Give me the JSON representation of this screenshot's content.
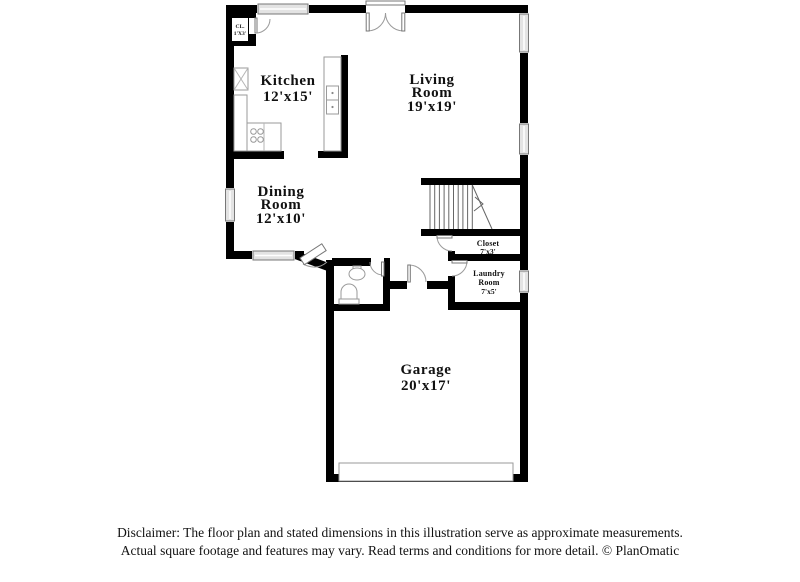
{
  "floor_plan": {
    "rooms": {
      "kitchen": {
        "name": "Kitchen",
        "dims": "12'x15'"
      },
      "living_room": {
        "name_1": "Living",
        "name_2": "Room",
        "dims": "19'x19'"
      },
      "dining_room": {
        "name_1": "Dining",
        "name_2": "Room",
        "dims": "12'x10'"
      },
      "garage": {
        "name": "Garage",
        "dims": "20'x17'"
      },
      "closet": {
        "name": "Closet",
        "dims": "7'x3'"
      },
      "laundry_room": {
        "name_1": "Laundry",
        "name_2": "Room",
        "dims": "7'x5'"
      },
      "entry_closet": {
        "name": "CL.",
        "dims": "1'X3'"
      }
    }
  },
  "footer": {
    "line1": "Disclaimer: The floor plan and stated dimensions in this illustration serve as approximate measurements.",
    "line2": "Actual square footage and features may vary. Read terms and conditions for more detail. © PlanOmatic"
  },
  "colors": {
    "walls": "#000000",
    "window_fill": "#e3e3e3",
    "fixture_line": "#9a9a9a",
    "text": "#111111"
  }
}
